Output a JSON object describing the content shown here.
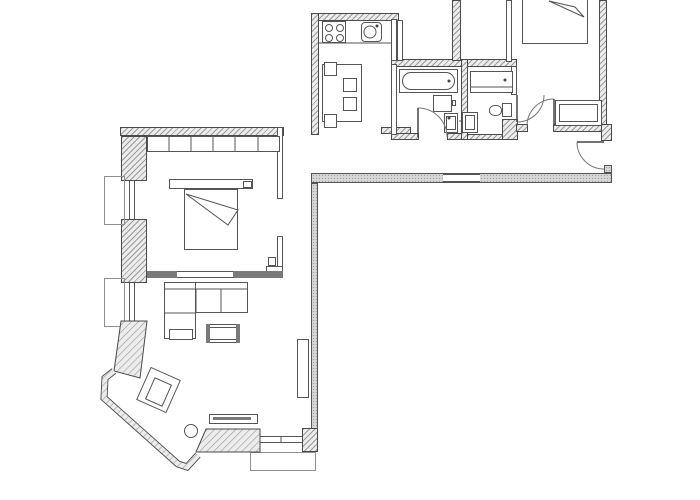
{
  "meta": {
    "type": "architectural-floor-plan",
    "text_visible": "none"
  },
  "palette": {
    "background": "#ffffff",
    "line": "#4a4a4a",
    "hatch": "#9a9a9a",
    "wall_light": "#ececec",
    "stipple": "#d6d6d6",
    "accent": "#7a7a7a"
  },
  "plan": {
    "rooms": [
      {
        "n": "room-kitchen",
        "x": 321,
        "y": 21,
        "w": 70,
        "h": 106
      },
      {
        "n": "room-bathroom-1",
        "x": 397,
        "y": 67,
        "w": 64,
        "h": 66
      },
      {
        "n": "room-bathroom-2",
        "x": 468,
        "y": 71,
        "w": 43,
        "h": 63
      },
      {
        "n": "room-bedroom-2",
        "x": 512,
        "y": 0,
        "w": 87,
        "h": 124
      },
      {
        "n": "room-hallway",
        "x": 318,
        "y": 132,
        "w": 286,
        "h": 41
      },
      {
        "n": "room-bedroom-1",
        "x": 147,
        "y": 136,
        "w": 130,
        "h": 135
      },
      {
        "n": "room-living-room",
        "x": 147,
        "y": 278,
        "w": 164,
        "h": 174
      }
    ],
    "stipple_walls": [
      {
        "n": "corridor-bottom-wall",
        "x": 311,
        "y": 173,
        "w": 301,
        "h": 10
      },
      {
        "n": "living-room-right-wall",
        "x": 311,
        "y": 183,
        "w": 7,
        "h": 247
      },
      {
        "n": "corridor-end-stub",
        "x": 604,
        "y": 165,
        "w": 8,
        "h": 8
      }
    ],
    "hatched_walls": [
      {
        "n": "kitchen-top-wall",
        "x": 311,
        "y": 13,
        "w": 88,
        "h": 8
      },
      {
        "n": "kitchen-left-wall",
        "x": 311,
        "y": 13,
        "w": 8,
        "h": 122
      },
      {
        "n": "bath-block-top-wall",
        "x": 391,
        "y": 59,
        "w": 126,
        "h": 8
      },
      {
        "n": "shaft-right-wall",
        "x": 452,
        "y": 0,
        "w": 9,
        "h": 61
      },
      {
        "n": "bath-divider-wall",
        "x": 461,
        "y": 59,
        "w": 7,
        "h": 81
      },
      {
        "n": "bath1-bottom-left-stub",
        "x": 391,
        "y": 133,
        "w": 28,
        "h": 7
      },
      {
        "n": "bath1-bottom-right-stub",
        "x": 447,
        "y": 133,
        "w": 15,
        "h": 7
      },
      {
        "n": "bath2-bottom-wall",
        "x": 467,
        "y": 134,
        "w": 36,
        "h": 6
      },
      {
        "n": "bath2-door-pier",
        "x": 502,
        "y": 119,
        "w": 16,
        "h": 21
      },
      {
        "n": "bedroom2-bottom-wall-left",
        "x": 516,
        "y": 124,
        "w": 12,
        "h": 8
      },
      {
        "n": "bedroom2-bottom-wall-right",
        "x": 553,
        "y": 124,
        "w": 49,
        "h": 8
      },
      {
        "n": "entry-corner-pier",
        "x": 601,
        "y": 124,
        "w": 11,
        "h": 17
      },
      {
        "n": "bedroom2-right-wall",
        "x": 599,
        "y": 0,
        "w": 8,
        "h": 125
      },
      {
        "n": "bedroom1-top-wall",
        "x": 120,
        "y": 127,
        "w": 164,
        "h": 9
      },
      {
        "n": "window-pier-1",
        "x": 121,
        "y": 136,
        "w": 26,
        "h": 45
      },
      {
        "n": "window-pier-2",
        "x": 121,
        "y": 219,
        "w": 26,
        "h": 64
      },
      {
        "n": "kitchen-entry-stub",
        "x": 381,
        "y": 127,
        "w": 30,
        "h": 7
      },
      {
        "n": "living-bottom-right-pier",
        "x": 302,
        "y": 428,
        "w": 16,
        "h": 24
      }
    ],
    "thin_walls": [
      {
        "n": "kitchen-right-wall",
        "x": 391,
        "y": 19,
        "w": 6,
        "h": 42
      },
      {
        "n": "shaft-left-wall",
        "x": 397,
        "y": 20,
        "w": 6,
        "h": 41
      },
      {
        "n": "bath1-left-wall",
        "x": 391,
        "y": 64,
        "w": 6,
        "h": 71
      },
      {
        "n": "bedroom2-left-wall",
        "x": 506,
        "y": 0,
        "w": 6,
        "h": 62
      },
      {
        "n": "bath2-right-wall",
        "x": 511,
        "y": 66,
        "w": 6,
        "h": 29
      },
      {
        "n": "bedroom1-right-wall-upper",
        "x": 277,
        "y": 127,
        "w": 6,
        "h": 72
      },
      {
        "n": "bedroom1-right-wall-lower",
        "x": 277,
        "y": 236,
        "w": 6,
        "h": 36
      },
      {
        "n": "bedroom1-right-wall-foot",
        "x": 266,
        "y": 266,
        "w": 17,
        "h": 6
      },
      {
        "n": "bedroom1-bottom-wall",
        "x": 147,
        "y": 271,
        "w": 136,
        "h": 7
      },
      {
        "n": "door-notch",
        "x": 268,
        "y": 257,
        "w": 8,
        "h": 9
      }
    ],
    "windows": [
      {
        "n": "window-left-1",
        "x": 129,
        "y": 181,
        "w": 6,
        "h": 38,
        "c": "win-v"
      },
      {
        "n": "window-left-2",
        "x": 129,
        "y": 283,
        "w": 6,
        "h": 38,
        "c": "win-v"
      },
      {
        "n": "window-bottom",
        "x": 260,
        "y": 436,
        "w": 42,
        "h": 7,
        "c": "win-h"
      },
      {
        "n": "corridor-wall-opening",
        "x": 443,
        "y": 174,
        "w": 37,
        "h": 8,
        "c": "win-h"
      }
    ],
    "sills": [
      {
        "n": "window-sill-1",
        "x": 104,
        "y": 176,
        "w": 21,
        "h": 49
      },
      {
        "n": "window-sill-2",
        "x": 104,
        "y": 278,
        "w": 21,
        "h": 49
      },
      {
        "n": "bay-window-sill",
        "x": 250,
        "y": 452,
        "w": 66,
        "h": 19
      }
    ],
    "furniture": [
      {
        "n": "kitchen-stove",
        "x": 322,
        "y": 21,
        "w": 24,
        "h": 22
      },
      {
        "n": "kitchen-sink-unit",
        "x": 361,
        "y": 22,
        "w": 21,
        "h": 20,
        "r": "4px"
      },
      {
        "n": "dining-table",
        "x": 322,
        "y": 64,
        "w": 40,
        "h": 58
      },
      {
        "n": "dining-chair-1",
        "x": 324,
        "y": 62,
        "w": 13,
        "h": 14
      },
      {
        "n": "dining-chair-2",
        "x": 343,
        "y": 78,
        "w": 14,
        "h": 14
      },
      {
        "n": "dining-chair-3",
        "x": 343,
        "y": 97,
        "w": 14,
        "h": 14
      },
      {
        "n": "dining-chair-4",
        "x": 324,
        "y": 114,
        "w": 13,
        "h": 14
      },
      {
        "n": "bathtub",
        "x": 399,
        "y": 69,
        "w": 59,
        "h": 24
      },
      {
        "n": "bathtub-inner",
        "x": 402,
        "y": 72,
        "w": 53,
        "h": 18,
        "r": "9px"
      },
      {
        "n": "washing-machine",
        "x": 433,
        "y": 95,
        "w": 19,
        "h": 17
      },
      {
        "n": "washer-connector",
        "x": 452,
        "y": 100,
        "w": 4,
        "h": 6
      },
      {
        "n": "bath1-sink",
        "x": 444,
        "y": 113,
        "w": 14,
        "h": 20
      },
      {
        "n": "bath1-sink-inner",
        "x": 446,
        "y": 116,
        "w": 10,
        "h": 14
      },
      {
        "n": "bath2-shower-tub",
        "x": 470,
        "y": 71,
        "w": 43,
        "h": 22
      },
      {
        "n": "toilet-tank",
        "x": 502,
        "y": 103,
        "w": 10,
        "h": 14
      },
      {
        "n": "toilet-bowl",
        "x": 489,
        "y": 105,
        "w": 13,
        "h": 11,
        "r": "45%"
      },
      {
        "n": "bath2-sink",
        "x": 462,
        "y": 112,
        "w": 16,
        "h": 21
      },
      {
        "n": "bath2-sink-inner",
        "x": 465,
        "y": 115,
        "w": 10,
        "h": 15
      },
      {
        "n": "bed-2",
        "x": 522,
        "y": -20,
        "w": 66,
        "h": 64
      },
      {
        "n": "wardrobe-2",
        "x": 555,
        "y": 100,
        "w": 47,
        "h": 26
      },
      {
        "n": "wardrobe-2-inner",
        "x": 559,
        "y": 104,
        "w": 39,
        "h": 18
      },
      {
        "n": "wardrobe-1",
        "x": 147,
        "y": 136,
        "w": 133,
        "h": 16
      },
      {
        "n": "headboard-shelf",
        "x": 169,
        "y": 179,
        "w": 84,
        "h": 10
      },
      {
        "n": "headboard-box",
        "x": 243,
        "y": 181,
        "w": 9,
        "h": 7
      },
      {
        "n": "bed-1",
        "x": 184,
        "y": 189,
        "w": 54,
        "h": 61
      },
      {
        "n": "sofa-body",
        "x": 164,
        "y": 282,
        "w": 84,
        "h": 31
      },
      {
        "n": "sofa-chaise",
        "x": 164,
        "y": 282,
        "w": 32,
        "h": 57
      },
      {
        "n": "sofa-foot-cushion",
        "x": 169,
        "y": 329,
        "w": 24,
        "h": 11
      },
      {
        "n": "coffee-table",
        "x": 206,
        "y": 324,
        "w": 34,
        "h": 19
      },
      {
        "n": "coffee-table-inner",
        "x": 209,
        "y": 327,
        "w": 28,
        "h": 13
      },
      {
        "n": "sideboard-tv",
        "x": 209,
        "y": 414,
        "w": 49,
        "h": 10
      },
      {
        "n": "shelf-unit",
        "x": 297,
        "y": 339,
        "w": 12,
        "h": 59
      },
      {
        "n": "armchair-outer",
        "x": 142,
        "y": 372,
        "w": 33,
        "h": 36,
        "rot": 24
      },
      {
        "n": "armchair-inner",
        "x": 149,
        "y": 380,
        "w": 19,
        "h": 24,
        "rot": 24
      }
    ],
    "accents": [
      {
        "n": "coffee-table-end-left",
        "x": 206,
        "y": 324,
        "w": 4,
        "h": 19
      },
      {
        "n": "coffee-table-end-right",
        "x": 236,
        "y": 324,
        "w": 4,
        "h": 19
      },
      {
        "n": "sideboard-tv-screen",
        "x": 213,
        "y": 417,
        "w": 38,
        "h": 3
      },
      {
        "n": "bedroom1-wall-cap-left",
        "x": 147,
        "y": 271,
        "w": 30,
        "h": 7
      },
      {
        "n": "bedroom1-wall-cap-right",
        "x": 233,
        "y": 271,
        "w": 50,
        "h": 7
      }
    ]
  },
  "svg": {
    "hatched_polygons": [
      {
        "n": "window-pier-3-angled",
        "points": "121,321 147,321 140,378 114,371"
      },
      {
        "n": "bay-bottom-pier",
        "points": "206,429 260,429 260,452 196,452"
      }
    ],
    "bay_wall": {
      "n": "bay-window-wall",
      "points": "114,371 105,378 104,398 178,464 187,467 198,455"
    },
    "fold_triangles": [
      {
        "n": "bed1-blanket-fold",
        "points": "186,194 238,210 228,225"
      },
      {
        "n": "bed2-blanket-fold",
        "points": "549,1 584,17 575,7"
      }
    ],
    "lines": [
      {
        "n": "kitchen-counter-edge",
        "x1": 319,
        "y1": 43,
        "x2": 391,
        "y2": 43
      },
      {
        "n": "bath2-shower-inner-line",
        "x1": 470,
        "y1": 87,
        "x2": 513,
        "y2": 87
      },
      {
        "n": "wardrobe1-divider-1",
        "x1": 169,
        "y1": 137,
        "x2": 169,
        "y2": 152
      },
      {
        "n": "wardrobe1-divider-2",
        "x1": 191,
        "y1": 137,
        "x2": 191,
        "y2": 152
      },
      {
        "n": "wardrobe1-divider-3",
        "x1": 213,
        "y1": 137,
        "x2": 213,
        "y2": 152
      },
      {
        "n": "wardrobe1-divider-4",
        "x1": 235,
        "y1": 137,
        "x2": 235,
        "y2": 152
      },
      {
        "n": "wardrobe1-divider-5",
        "x1": 258,
        "y1": 137,
        "x2": 258,
        "y2": 152
      },
      {
        "n": "sofa-back-line",
        "x1": 164,
        "y1": 289,
        "x2": 248,
        "y2": 289
      },
      {
        "n": "sofa-cushion-div-1",
        "x1": 196,
        "y1": 289,
        "x2": 196,
        "y2": 313
      },
      {
        "n": "sofa-cushion-div-2",
        "x1": 221,
        "y1": 289,
        "x2": 221,
        "y2": 313
      },
      {
        "n": "sofa-chaise-seat-line",
        "x1": 164,
        "y1": 313,
        "x2": 196,
        "y2": 313
      },
      {
        "n": "window-bottom-tick",
        "x1": 281,
        "y1": 436,
        "x2": 281,
        "y2": 443
      },
      {
        "n": "bath2-sink-tap",
        "x1": 459,
        "y1": 121,
        "x2": 463,
        "y2": 121
      }
    ],
    "circles": [
      {
        "n": "stove-burner-1",
        "cx": 329,
        "cy": 28,
        "r": 3.5
      },
      {
        "n": "stove-burner-2",
        "cx": 340,
        "cy": 28,
        "r": 3.5
      },
      {
        "n": "stove-burner-3",
        "cx": 329,
        "cy": 38,
        "r": 3.5
      },
      {
        "n": "stove-burner-4",
        "cx": 340,
        "cy": 38,
        "r": 3.5
      },
      {
        "n": "sink-basin",
        "cx": 370,
        "cy": 32,
        "r": 6
      },
      {
        "n": "floor-lamp",
        "cx": 191,
        "cy": 431,
        "r": 6.5
      }
    ],
    "dots": [
      {
        "n": "bathtub-drain-dot",
        "cx": 449,
        "cy": 81,
        "r": 1.5
      },
      {
        "n": "shower-drain-dot",
        "cx": 505,
        "cy": 80,
        "r": 1.5
      },
      {
        "n": "bath1-sink-tap-dot",
        "cx": 449,
        "cy": 118,
        "r": 1.5
      },
      {
        "n": "kitchen-sink-tap-dot",
        "cx": 377,
        "cy": 26,
        "r": 1.5
      }
    ],
    "doors": [
      {
        "n": "bathroom1-door",
        "leaf": [
          418,
          137,
          418,
          108
        ],
        "arc": "M418,108 A29,29 0 0 1 447,137"
      },
      {
        "n": "bathroom2-door",
        "leaf": [
          517,
          95,
          517,
          122
        ],
        "arc": "M544,95 A27,27 0 0 1 517,122"
      },
      {
        "n": "bedroom2-door",
        "leaf": [
          554,
          126,
          554,
          99
        ],
        "arc": "M554,99 A27,27 0 0 0 527,126"
      },
      {
        "n": "entry-door",
        "leaf": [
          604,
          142,
          577,
          142
        ],
        "arc": "M577,142 A27,27 0 0 0 604,169"
      }
    ]
  }
}
